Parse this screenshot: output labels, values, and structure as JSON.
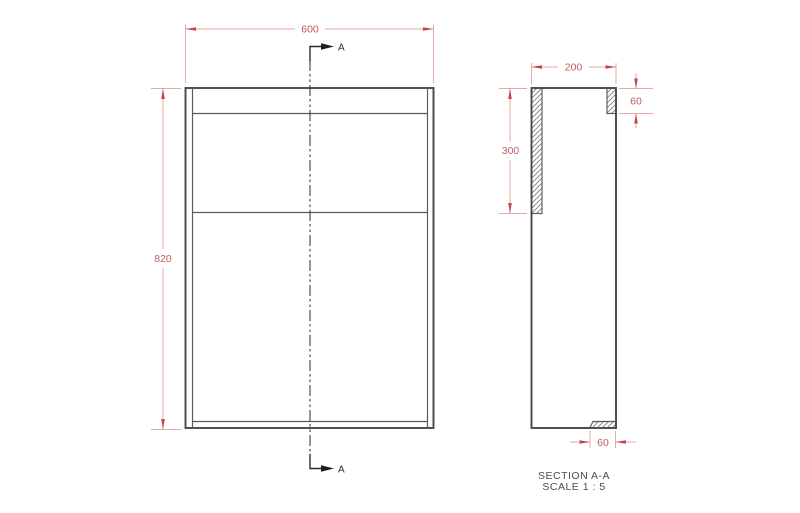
{
  "front_view": {
    "width_dim": "600",
    "height_dim": "820",
    "cut_label_top": "A",
    "cut_label_bottom": "A"
  },
  "section_view": {
    "depth_dim": "200",
    "back_panel_dim": "300",
    "top_rail_dim": "60",
    "bottom_rail_dim": "60",
    "caption_title": "SECTION A-A",
    "caption_scale": "SCALE 1 : 5"
  },
  "colors": {
    "background": "#ffffff",
    "outline": "#474747",
    "thin_line": "#5a5a5a",
    "hatch": "#7f7f7f",
    "cut_line": "#2c2c2c",
    "dim_line": "#e2aaaa",
    "dim_arrow": "#cc4343",
    "dim_text": "#c05c5c",
    "caption_text": "#4d4d4d"
  }
}
